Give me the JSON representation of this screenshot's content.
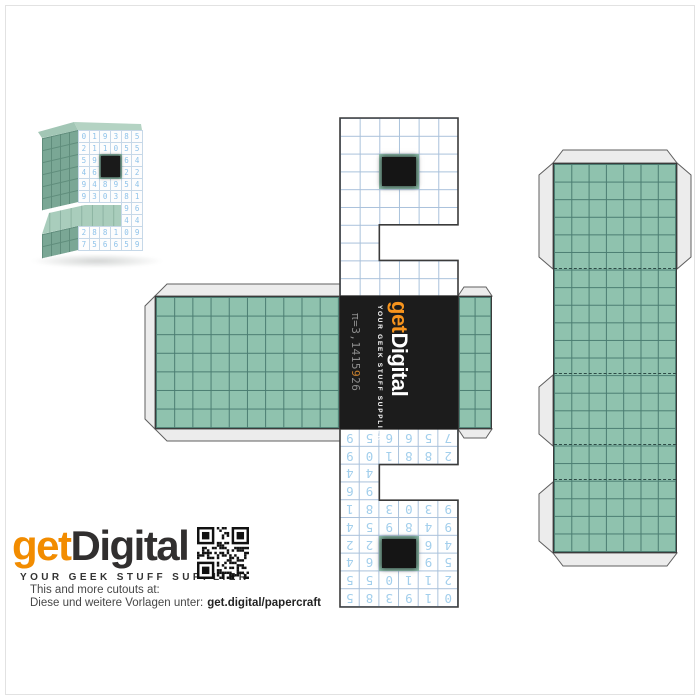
{
  "faces": {
    "grid_cols": 6,
    "grid_rows": 10,
    "front_digits": [
      [
        "0",
        "1",
        "9",
        "3",
        "8",
        "5"
      ],
      [
        "2",
        "1",
        "1",
        "0",
        "5",
        "5"
      ],
      [
        "5",
        "9",
        "",
        "",
        "6",
        "4"
      ],
      [
        "4",
        "6",
        "",
        "",
        "2",
        "2"
      ],
      [
        "9",
        "4",
        "8",
        "9",
        "5",
        "4"
      ],
      [
        "9",
        "3",
        "0",
        "3",
        "8",
        "1"
      ],
      [
        "",
        "",
        "",
        "",
        "9",
        "6"
      ],
      [
        "",
        "",
        "",
        "",
        "4",
        "4"
      ],
      [
        "2",
        "8",
        "8",
        "1",
        "0",
        "9"
      ],
      [
        "7",
        "5",
        "6",
        "6",
        "5",
        "9"
      ]
    ],
    "hole": {
      "row": 3,
      "col": 3,
      "rows": 2,
      "cols": 2
    },
    "front_notch": {
      "row": 7,
      "col": 1,
      "rows": 2,
      "cols": 4
    },
    "back_notch": {
      "row": 7,
      "col": 3,
      "rows": 2,
      "cols": 4
    }
  },
  "logo_panel": {
    "pi_before": "π=3,1415",
    "pi_highlight": "9",
    "pi_after": "26",
    "logo_get": "get",
    "logo_digital": "Digital",
    "tagline": "YOUR GEEK STUFF SUPPLIER"
  },
  "branding": {
    "logo_get": "get",
    "logo_digital": "Digital",
    "tagline": "YOUR GEEK STUFF SUPPLIER",
    "line_en": "This and more cutouts at:",
    "line_de": "Diese und weitere Vorlagen unter:",
    "link": "get.digital/papercraft"
  },
  "colors": {
    "teal": "#8fc2ae",
    "teal_line": "#4a7c71",
    "digit_blue": "#a3cfec",
    "grid_blue": "#a9c1db",
    "orange": "#f7941d",
    "panel_black": "#1c1c1c",
    "outline": "#3b3b3b",
    "flap_gray": "#ececec"
  }
}
